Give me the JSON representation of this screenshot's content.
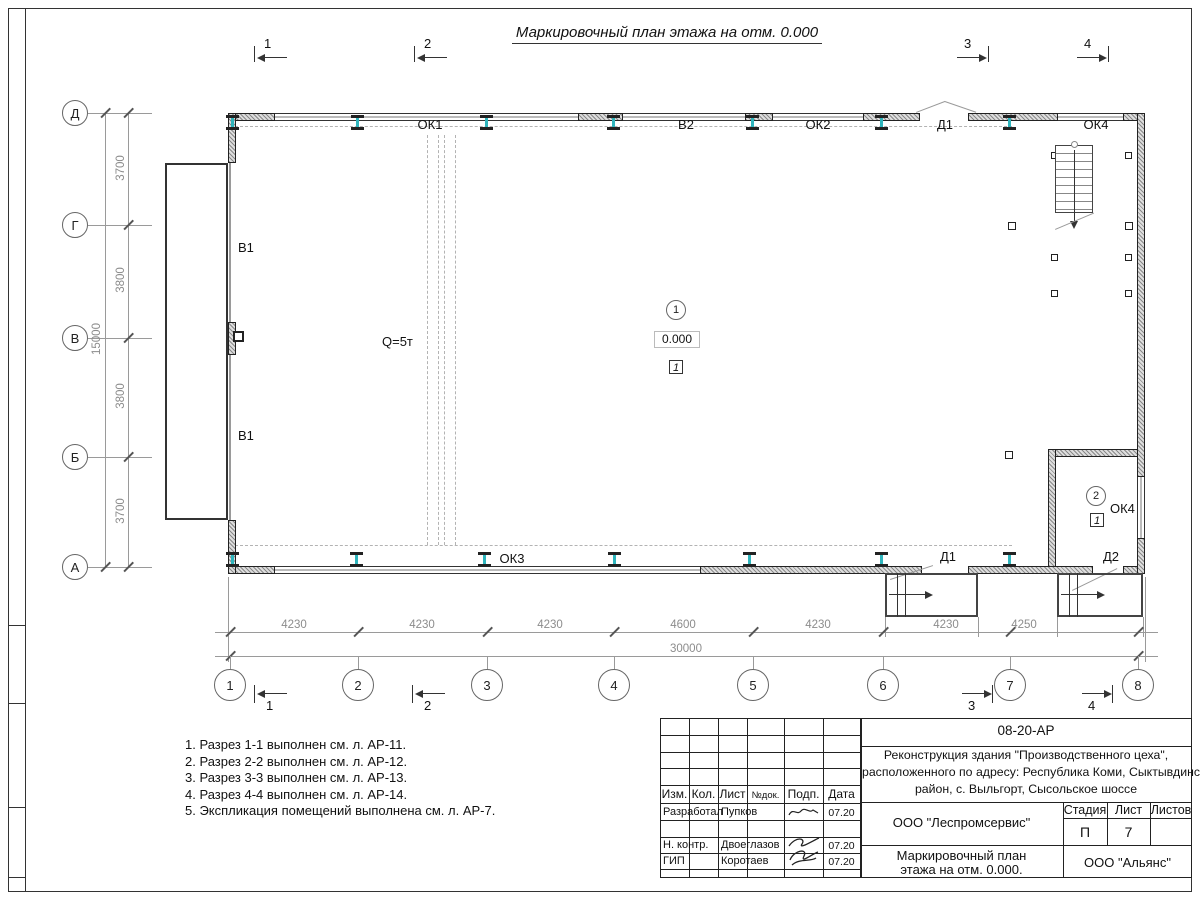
{
  "title": "Маркировочный план этажа на отм. 0.000",
  "marks": {
    "s1": "1",
    "s2": "2",
    "s3": "3",
    "s4": "4"
  },
  "axes": {
    "h": [
      "Д",
      "Г",
      "В",
      "Б",
      "А"
    ],
    "v": [
      "1",
      "2",
      "3",
      "4",
      "5",
      "6",
      "7",
      "8"
    ]
  },
  "dims": {
    "left": [
      "3700",
      "3800",
      "3800",
      "3700"
    ],
    "left_total": "15000",
    "bottom": [
      "4230",
      "4230",
      "4230",
      "4600",
      "4230",
      "4230",
      "4250"
    ],
    "bottom_total": "30000"
  },
  "plan": {
    "ok1": "ОК1",
    "v2": "В2",
    "ok2": "ОК2",
    "d1_top": "Д1",
    "ok4_top": "ОК4",
    "v1_a": "В1",
    "v1_b": "В1",
    "q": "Q=5т",
    "r1_num": "1",
    "r1_level": "0.000",
    "r1_floor": "1",
    "ok3": "ОК3",
    "d1_bot": "Д1",
    "d2": "Д2",
    "r2_num": "2",
    "r2_ok": "ОК4",
    "r2_floor": "1"
  },
  "notes": [
    "1. Разрез 1-1 выполнен см. л. АР-11.",
    "2. Разрез 2-2 выполнен см. л. АР-12.",
    "3. Разрез 3-3 выполнен см. л. АР-13.",
    "4. Разрез 4-4 выполнен см. л. АР-14.",
    "5. Экспликация помещений выполнена см. л. АР-7."
  ],
  "tb": {
    "code": "08-20-АР",
    "p1": "Реконструкция здания \"Производственного цеха\",",
    "p2": "расположенного по адресу: Республика Коми, Сыктывдинский",
    "p3": "район, с. Выльгорт, Сысольское шоссе",
    "h_izm": "Изм.",
    "h_kol": "Кол.",
    "h_list": "Лист",
    "h_ndok": "№док.",
    "h_podp": "Подп.",
    "h_data": "Дата",
    "rows": [
      {
        "role": "Разработал",
        "name": "Пупков",
        "date": "07.20"
      },
      {
        "role": "Н. контр.",
        "name": "Двоеглазов",
        "date": "07.20"
      },
      {
        "role": "ГИП",
        "name": "Коротаев",
        "date": "07.20"
      }
    ],
    "org": "ООО \"Леспромсервис\"",
    "stage_label": "Стадия",
    "sheet_label": "Лист",
    "sheets_label": "Листов",
    "stage": "П",
    "sheet_num": "7",
    "t1": "Маркировочный план",
    "t2": "этажа на отм. 0.000.",
    "company": "ООО \"Альянс\""
  }
}
